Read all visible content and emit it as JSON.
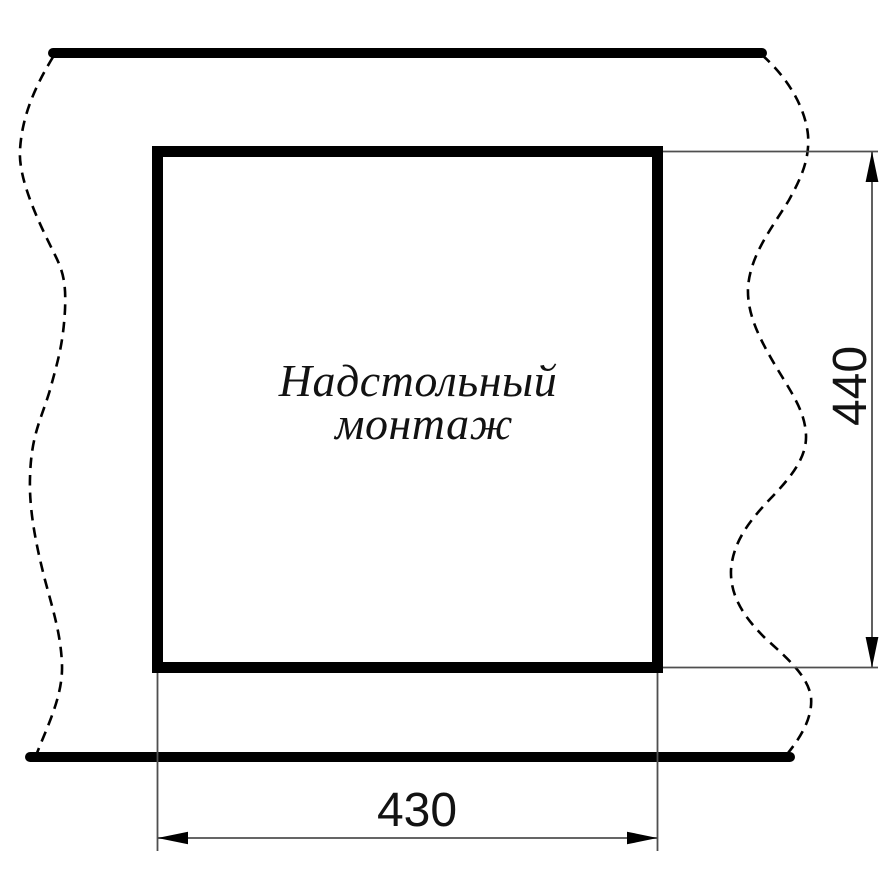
{
  "colors": {
    "background": "#ffffff",
    "ink": "#000000",
    "thin": "#4f4f4f",
    "text": "#121212"
  },
  "drawing": {
    "mount_label_line1": "Надстольный",
    "mount_label_line2": "монтаж",
    "width_dimension": "430",
    "height_dimension": "440"
  }
}
